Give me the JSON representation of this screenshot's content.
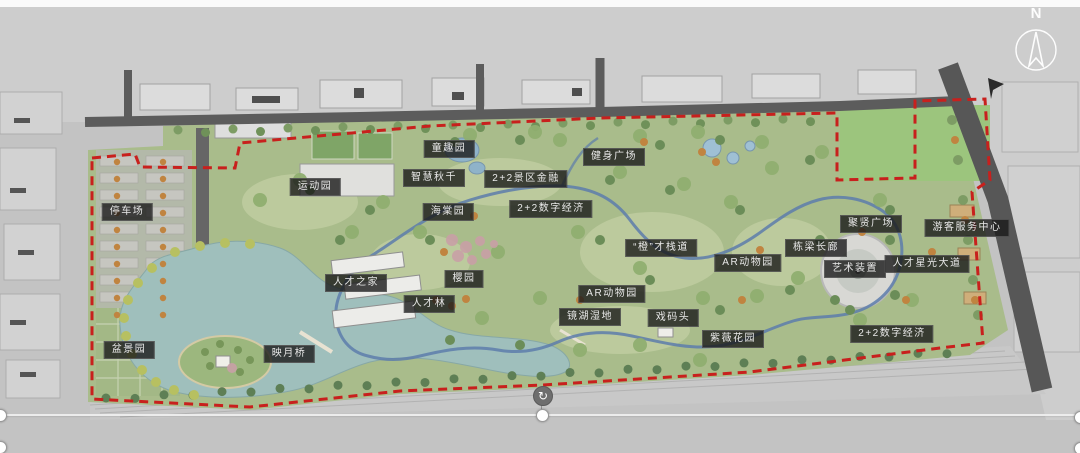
{
  "page": {
    "type": "landscape-masterplan-slide"
  },
  "colors": {
    "canvas-bg": "#c3c3c3",
    "context-bg": "#cdcdcd",
    "park-green": "#a9bc8b",
    "field-green": "#9cc57d",
    "lake-blue": "#9fbfbc",
    "road-gray": "#5c5c5c",
    "boundary-red": "#c8201d",
    "loop-path-blue": "#5d7cab",
    "label-bg": "#1a1a1a",
    "label-text": "#e9e9e9"
  },
  "compass": {
    "label": "N"
  },
  "icons": {
    "rotate_handle": "↻"
  },
  "map_labels": [
    {
      "id": "parking-lot",
      "text": "停车场",
      "x": 127,
      "y": 212
    },
    {
      "id": "sports-garden",
      "text": "运动园",
      "x": 315,
      "y": 187
    },
    {
      "id": "children-fun-garden",
      "text": "童趣园",
      "x": 449,
      "y": 149
    },
    {
      "id": "smart-swing",
      "text": "智慧秋千",
      "x": 434,
      "y": 178
    },
    {
      "id": "scenic-finance-2plus2",
      "text": "2+2景区金融",
      "x": 526,
      "y": 179
    },
    {
      "id": "fitness-plaza",
      "text": "健身广场",
      "x": 614,
      "y": 157
    },
    {
      "id": "begonia-garden",
      "text": "海棠园",
      "x": 448,
      "y": 212
    },
    {
      "id": "digital-economy-mid",
      "text": "2+2数字经济",
      "x": 551,
      "y": 209
    },
    {
      "id": "talent-home",
      "text": "人才之家",
      "x": 356,
      "y": 283
    },
    {
      "id": "cherry-garden",
      "text": "樱园",
      "x": 464,
      "y": 279
    },
    {
      "id": "talent-forest",
      "text": "人才林",
      "x": 429,
      "y": 304
    },
    {
      "id": "orange-talent-boardwalk",
      "text": "“橙”才栈道",
      "x": 661,
      "y": 248
    },
    {
      "id": "ar-zoo-upper",
      "text": "AR动物园",
      "x": 748,
      "y": 263
    },
    {
      "id": "beam-gallery",
      "text": "栋梁长廊",
      "x": 816,
      "y": 248
    },
    {
      "id": "art-installation",
      "text": "艺术装置",
      "x": 855,
      "y": 269
    },
    {
      "id": "ar-zoo-lower",
      "text": "AR动物园",
      "x": 612,
      "y": 294
    },
    {
      "id": "mirror-lake-wetland",
      "text": "镜湖湿地",
      "x": 590,
      "y": 317
    },
    {
      "id": "opera-dock",
      "text": "戏码头",
      "x": 673,
      "y": 318
    },
    {
      "id": "crape-myrtle-garden",
      "text": "紫薇花园",
      "x": 733,
      "y": 339
    },
    {
      "id": "juxian-plaza",
      "text": "聚贤广场",
      "x": 871,
      "y": 224
    },
    {
      "id": "visitor-service-center",
      "text": "游客服务中心",
      "x": 967,
      "y": 228
    },
    {
      "id": "talent-starlight-avenue",
      "text": "人才星光大道",
      "x": 927,
      "y": 264
    },
    {
      "id": "digital-economy-right",
      "text": "2+2数字经济",
      "x": 892,
      "y": 334
    },
    {
      "id": "bonsai-garden",
      "text": "盆景园",
      "x": 129,
      "y": 350
    },
    {
      "id": "moon-bridge",
      "text": "映月桥",
      "x": 289,
      "y": 354
    }
  ]
}
